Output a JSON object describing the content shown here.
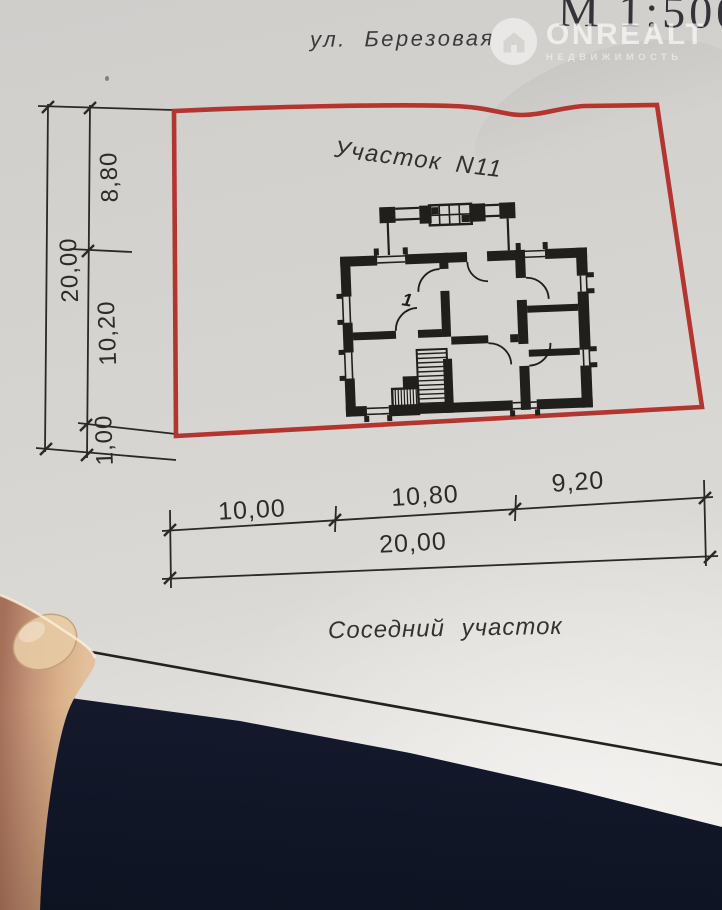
{
  "header": {
    "scale": "М 1:500",
    "street": "ул. Березовая"
  },
  "watermark": {
    "brand": "ONREALT",
    "subtitle": "НЕДВИЖИМОСТЬ",
    "icon": "house-icon"
  },
  "plot": {
    "title": "Участок N11",
    "house_number": "1",
    "neighbor": "Соседний участок"
  },
  "dimensions": {
    "left_segments": [
      "8,80",
      "10,20",
      "1,00"
    ],
    "left_total": "20,00",
    "bottom_segments": [
      "10,00",
      "10,80",
      "9,20"
    ],
    "bottom_total": "20,00"
  },
  "colors": {
    "plot_outline": "#b43530",
    "paper": "#d7d5d1",
    "ink": "#211f1b",
    "table": "#19203a"
  }
}
